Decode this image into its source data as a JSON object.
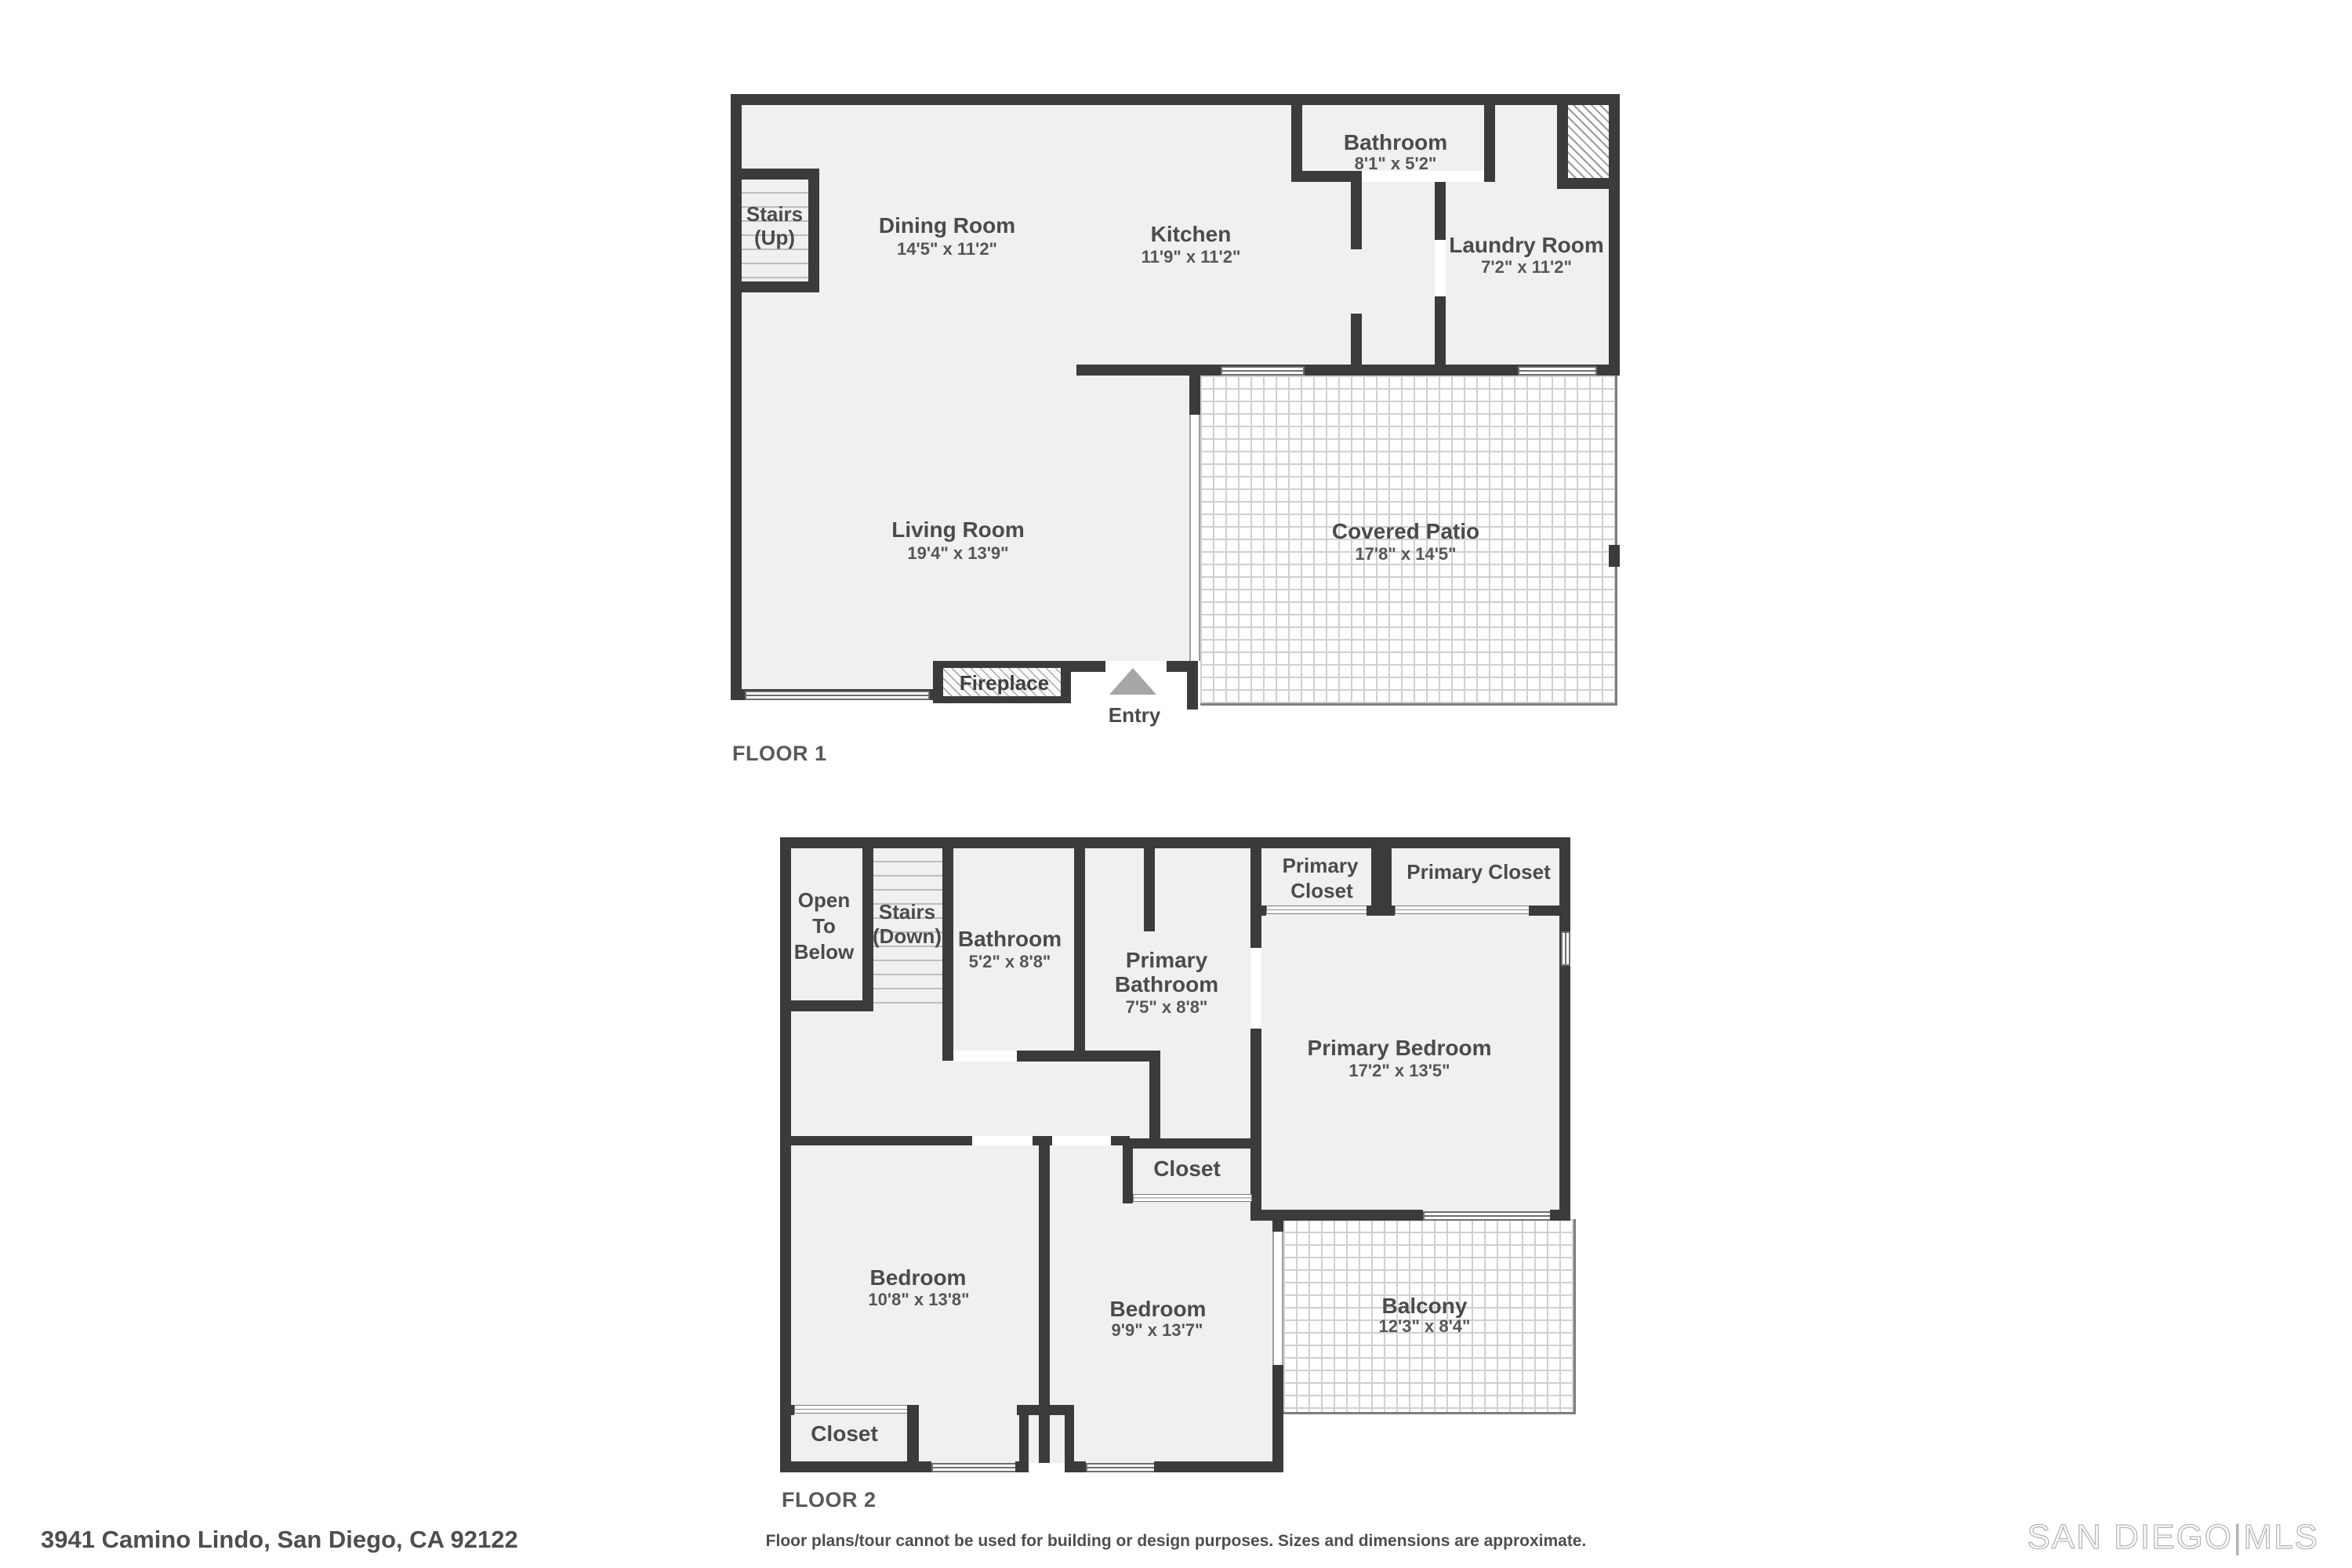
{
  "colors": {
    "wall": "#3b3b3b",
    "room_fill": "#f0f0ef",
    "tile_line": "#d0d0d0",
    "text": "#4b4b4b"
  },
  "floor1": {
    "label": "FLOOR 1",
    "stairs": {
      "line1": "Stairs",
      "line2": "(Up)"
    },
    "dining": {
      "name": "Dining Room",
      "dims": "14'5\" x 11'2\""
    },
    "kitchen": {
      "name": "Kitchen",
      "dims": "11'9\" x 11'2\""
    },
    "bathroom": {
      "name": "Bathroom",
      "dims": "8'1\" x 5'2\""
    },
    "laundry": {
      "name": "Laundry Room",
      "dims": "7'2\" x 11'2\""
    },
    "living": {
      "name": "Living Room",
      "dims": "19'4\" x 13'9\""
    },
    "patio": {
      "name": "Covered Patio",
      "dims": "17'8\" x 14'5\""
    },
    "fireplace": {
      "name": "Fireplace"
    },
    "entry": {
      "name": "Entry"
    }
  },
  "floor2": {
    "label": "FLOOR 2",
    "open_below": {
      "line1": "Open",
      "line2": "To",
      "line3": "Below"
    },
    "stairs": {
      "line1": "Stairs",
      "line2": "(Down)"
    },
    "bathroom": {
      "name": "Bathroom",
      "dims": "5'2\" x 8'8\""
    },
    "primary_bathroom": {
      "line1": "Primary",
      "line2": "Bathroom",
      "dims": "7'5\" x 8'8\""
    },
    "primary_closet_1": {
      "line1": "Primary",
      "line2": "Closet"
    },
    "primary_closet_2": {
      "name": "Primary Closet"
    },
    "primary_bedroom": {
      "name": "Primary Bedroom",
      "dims": "17'2\" x 13'5\""
    },
    "closet_mid": {
      "name": "Closet"
    },
    "bedroom1": {
      "name": "Bedroom",
      "dims": "10'8\" x 13'8\""
    },
    "bedroom2": {
      "name": "Bedroom",
      "dims": "9'9\" x 13'7\""
    },
    "balcony": {
      "name": "Balcony",
      "dims": "12'3\" x 8'4\""
    },
    "closet_bottom": {
      "name": "Closet"
    }
  },
  "footer": {
    "address": "3941 Camino Lindo, San Diego, CA 92122",
    "disclaimer": "Floor plans/tour cannot be used for building or design purposes. Sizes and dimensions are approximate.",
    "logo": {
      "part1": "SAN DIEGO",
      "sep": "|",
      "part2": "MLS"
    }
  }
}
